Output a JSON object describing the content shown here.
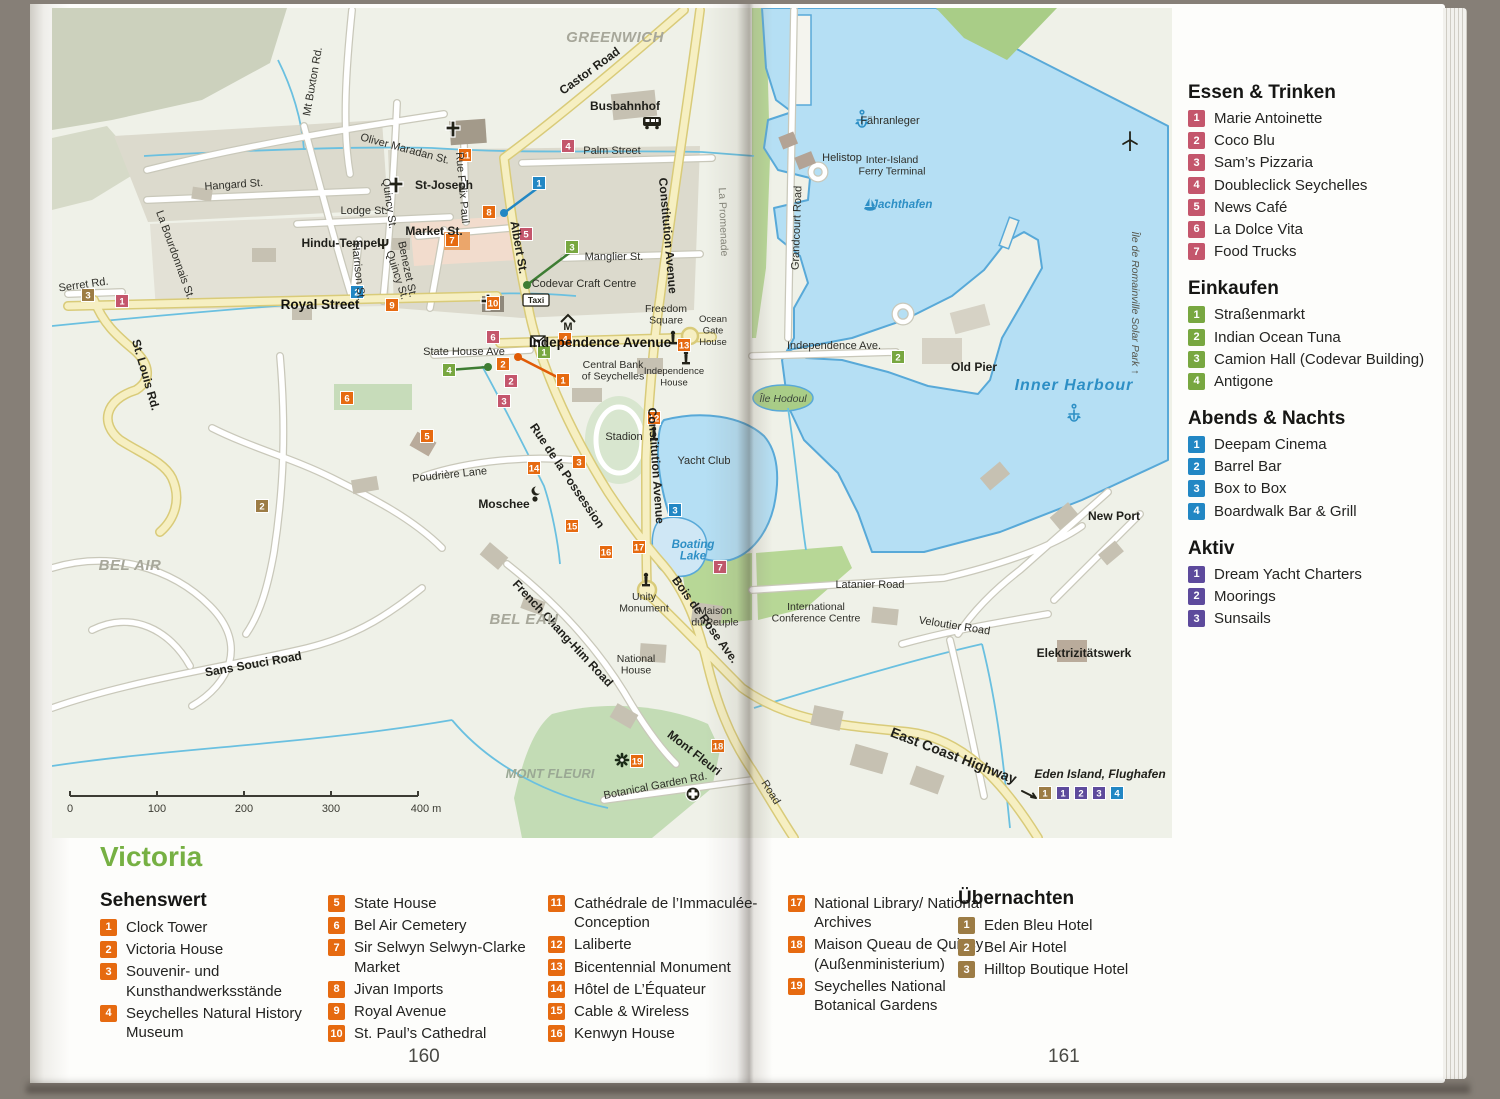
{
  "page": {
    "left_number": "160",
    "right_number": "161",
    "title": "Victoria"
  },
  "colors": {
    "essen": "#c4566c",
    "einkaufen": "#78a740",
    "abends": "#2287c4",
    "aktiv": "#5d4a9c",
    "sehenswert": "#e66a10",
    "uebernachten": "#9c7c45",
    "title_green": "#76b043",
    "water": "#b5dff4",
    "coast": "#58a9d8",
    "road_yellow": "#f6efc2",
    "land": "#eff1e8"
  },
  "sidebar_sections": [
    {
      "id": "essen",
      "title": "Essen & Trinken",
      "color": "#c4566c",
      "items": [
        "Marie Antoinette",
        "Coco Blu",
        "Sam’s Pizzaria",
        "Doubleclick Seychelles",
        "News Café",
        "La Dolce Vita",
        "Food Trucks"
      ]
    },
    {
      "id": "einkaufen",
      "title": "Einkaufen",
      "color": "#78a740",
      "items": [
        "Straßenmarkt",
        "Indian Ocean Tuna",
        "Camion Hall (Codevar Building)",
        "Antigone"
      ]
    },
    {
      "id": "abends",
      "title": "Abends & Nachts",
      "color": "#2287c4",
      "items": [
        "Deepam Cinema",
        "Barrel Bar",
        "Box to Box",
        "Boardwalk Bar & Grill"
      ]
    },
    {
      "id": "aktiv",
      "title": "Aktiv",
      "color": "#5d4a9c",
      "items": [
        "Dream Yacht Charters",
        "Moorings",
        "Sunsails"
      ]
    }
  ],
  "bottom_legend": {
    "sehenswert_title": "Sehenswert",
    "sehenswert_items": [
      "Clock Tower",
      "Victoria House",
      "Souvenir- und Kunsthandwerksstände",
      "Seychelles Natural History Museum",
      "State House",
      "Bel Air Cemetery",
      "Sir Selwyn Selwyn-Clarke Market",
      "Jivan Imports",
      "Royal Avenue",
      "St. Paul’s Cathedral",
      "Cathédrale de l’Immaculée-Conception",
      "Laliberte",
      "Bicentennial Monument",
      "Hôtel de L’Équateur",
      "Cable & Wireless",
      "Kenwyn House",
      "National Library/ National Archives",
      "Maison Queau de Quincy (Außenministerium)",
      "Seychelles National Botanical Gardens"
    ],
    "columns": [
      [
        1,
        4
      ],
      [
        5,
        10
      ],
      [
        11,
        16
      ],
      [
        17,
        19
      ]
    ],
    "uebernachten_title": "Übernachten",
    "uebernachten_items": [
      "Eden Bleu Hotel",
      "Bel Air Hotel",
      "Hilltop Boutique Hotel"
    ]
  },
  "map": {
    "scale": {
      "ticks": [
        "0",
        "100",
        "200",
        "300"
      ],
      "end": "400 m"
    },
    "labels": [
      {
        "t": "GREENWICH",
        "x": 563,
        "y": 34,
        "r": 0,
        "c": "area"
      },
      {
        "t": "Castor Road",
        "x": 540,
        "y": 66,
        "r": -36,
        "c": "stb"
      },
      {
        "t": "Busbahnhof",
        "x": 573,
        "y": 102,
        "r": 0,
        "c": "stb"
      },
      {
        "t": "Palm Street",
        "x": 560,
        "y": 146,
        "r": 0,
        "c": "st"
      },
      {
        "t": "St-Joseph",
        "x": 392,
        "y": 181,
        "r": 0,
        "c": "stb"
      },
      {
        "t": "Oliver Maradan St.",
        "x": 352,
        "y": 144,
        "r": 15,
        "c": "st"
      },
      {
        "t": "Mt Buxton Rd.",
        "x": 264,
        "y": 74,
        "r": -80,
        "c": "st"
      },
      {
        "t": "Hangard St.",
        "x": 182,
        "y": 180,
        "r": -4,
        "c": "st"
      },
      {
        "t": "La Bourdonnais St.",
        "x": 120,
        "y": 248,
        "r": 70,
        "c": "st"
      },
      {
        "t": "Lodge St.",
        "x": 312,
        "y": 206,
        "r": 0,
        "c": "st"
      },
      {
        "t": "Hindu-Tempel",
        "x": 289,
        "y": 239,
        "r": 0,
        "c": "stb"
      },
      {
        "t": "Quincy St.",
        "x": 334,
        "y": 196,
        "r": 82,
        "c": "st"
      },
      {
        "t": "Quincy St.",
        "x": 342,
        "y": 268,
        "r": 72,
        "c": "st"
      },
      {
        "t": "Harrison St.",
        "x": 303,
        "y": 264,
        "r": 84,
        "c": "st"
      },
      {
        "t": "Serret Rd.",
        "x": 32,
        "y": 280,
        "r": -8,
        "c": "st"
      },
      {
        "t": "Royal Street",
        "x": 268,
        "y": 301,
        "r": 0,
        "c": "big"
      },
      {
        "t": "St. Louis Rd.",
        "x": 90,
        "y": 368,
        "r": 74,
        "c": "stb"
      },
      {
        "t": "Rue Felix Paul",
        "x": 407,
        "y": 180,
        "r": 85,
        "c": "st"
      },
      {
        "t": "Benezet St.",
        "x": 352,
        "y": 262,
        "r": 78,
        "c": "st"
      },
      {
        "t": "Market St.",
        "x": 382,
        "y": 227,
        "r": 0,
        "c": "stb"
      },
      {
        "t": "Albert St.",
        "x": 463,
        "y": 240,
        "r": 80,
        "c": "stb"
      },
      {
        "t": "Codevar Craft Centre",
        "x": 532,
        "y": 279,
        "r": 0,
        "c": "st"
      },
      {
        "t": "Manglier St.",
        "x": 562,
        "y": 252,
        "r": 0,
        "c": "st"
      },
      {
        "t": "Constitution Avenue",
        "x": 612,
        "y": 228,
        "r": 85,
        "c": "stb"
      },
      {
        "t": "Constitution Avenue",
        "x": 600,
        "y": 458,
        "r": 86,
        "c": "stb"
      },
      {
        "t": "La Promenade",
        "x": 668,
        "y": 214,
        "r": 88,
        "c": "gray"
      },
      {
        "t": "Freedom\nSquare",
        "x": 614,
        "y": 304,
        "r": 0,
        "c": "st-c"
      },
      {
        "t": "Ocean\nGate\nHouse",
        "x": 661,
        "y": 314,
        "r": 0,
        "c": "tiny-c"
      },
      {
        "t": "Independence Avenue",
        "x": 548,
        "y": 339,
        "r": 0,
        "c": "big"
      },
      {
        "t": "Central Bank\nof Seychelles",
        "x": 561,
        "y": 360,
        "r": 0,
        "c": "st-c"
      },
      {
        "t": "Independence\nHouse",
        "x": 622,
        "y": 366,
        "r": 0,
        "c": "tiny-c"
      },
      {
        "t": "State House Ave",
        "x": 412,
        "y": 347,
        "r": 0,
        "c": "st"
      },
      {
        "t": "Stadion",
        "x": 572,
        "y": 432,
        "r": 0,
        "c": "st"
      },
      {
        "t": "Yacht Club",
        "x": 652,
        "y": 456,
        "r": 0,
        "c": "st"
      },
      {
        "t": "Boating\nLake",
        "x": 641,
        "y": 540,
        "r": 0,
        "c": "water-sm"
      },
      {
        "t": "Île Hodoul",
        "x": 731,
        "y": 394,
        "r": 0,
        "c": "island"
      },
      {
        "t": "Unity\nMonument",
        "x": 592,
        "y": 592,
        "r": 0,
        "c": "st-c"
      },
      {
        "t": "Bois de Rose Ave.",
        "x": 650,
        "y": 614,
        "r": 54,
        "c": "stb"
      },
      {
        "t": "Maison\ndu Peuple",
        "x": 663,
        "y": 606,
        "r": 0,
        "c": "st-c"
      },
      {
        "t": "National\nHouse",
        "x": 584,
        "y": 654,
        "r": 0,
        "c": "st-c"
      },
      {
        "t": "French Chang-Him Road",
        "x": 508,
        "y": 628,
        "r": 47,
        "c": "stb"
      },
      {
        "t": "Sans Souci Road",
        "x": 202,
        "y": 660,
        "r": -10,
        "c": "stb"
      },
      {
        "t": "Poudrière Lane",
        "x": 398,
        "y": 470,
        "r": -6,
        "c": "st"
      },
      {
        "t": "Moschee",
        "x": 452,
        "y": 500,
        "r": 0,
        "c": "stb"
      },
      {
        "t": "Rue de la Possession",
        "x": 512,
        "y": 470,
        "r": 56,
        "c": "stb"
      },
      {
        "t": "Mont Fleuri",
        "x": 640,
        "y": 748,
        "r": 38,
        "c": "stb"
      },
      {
        "t": "Botanical Garden Rd.",
        "x": 604,
        "y": 781,
        "r": -11,
        "c": "st"
      },
      {
        "t": "BEL AIR",
        "x": 78,
        "y": 562,
        "r": 0,
        "c": "area"
      },
      {
        "t": "BEL EAU",
        "x": 472,
        "y": 616,
        "r": 0,
        "c": "area"
      },
      {
        "t": "MONT FLEURI",
        "x": 498,
        "y": 770,
        "r": 0,
        "c": "area2"
      },
      {
        "t": "Fähranleger",
        "x": 838,
        "y": 116,
        "r": 0,
        "c": "st"
      },
      {
        "t": "Helistop",
        "x": 790,
        "y": 153,
        "r": 0,
        "c": "st"
      },
      {
        "t": "Inter-Island\nFerry Terminal",
        "x": 840,
        "y": 155,
        "r": 0,
        "c": "st-c"
      },
      {
        "t": "Jachthafen",
        "x": 850,
        "y": 200,
        "r": 0,
        "c": "water-sm"
      },
      {
        "t": "Grandcourt Road",
        "x": 748,
        "y": 220,
        "r": -88,
        "c": "st"
      },
      {
        "t": "Independence Ave.",
        "x": 782,
        "y": 341,
        "r": 0,
        "c": "st"
      },
      {
        "t": "Old Pier",
        "x": 922,
        "y": 363,
        "r": 0,
        "c": "stb"
      },
      {
        "t": "Inner Harbour",
        "x": 1022,
        "y": 382,
        "r": 0,
        "c": "water"
      },
      {
        "t": "Île de Romainville Solar Park ↑",
        "x": 1080,
        "y": 295,
        "r": 90,
        "c": "solar"
      },
      {
        "t": "New Port",
        "x": 1062,
        "y": 512,
        "r": 0,
        "c": "stb"
      },
      {
        "t": "Latanier Road",
        "x": 818,
        "y": 580,
        "r": 0,
        "c": "st"
      },
      {
        "t": "International\nConference Centre",
        "x": 764,
        "y": 602,
        "r": 0,
        "c": "st-c"
      },
      {
        "t": "Veloutier Road",
        "x": 902,
        "y": 621,
        "r": 9,
        "c": "st"
      },
      {
        "t": "Elektrizitätswerk",
        "x": 1032,
        "y": 649,
        "r": 0,
        "c": "stb"
      },
      {
        "t": "East Coast Highway",
        "x": 900,
        "y": 752,
        "r": 21,
        "c": "hwy"
      },
      {
        "t": "Eden Island, Flughafen",
        "x": 1048,
        "y": 770,
        "r": 0,
        "c": "edn"
      },
      {
        "t": "Road",
        "x": 716,
        "y": 786,
        "r": 58,
        "c": "st"
      }
    ],
    "markers": [
      {
        "g": "sehenswert",
        "n": "1",
        "x": 511,
        "y": 372
      },
      {
        "g": "sehenswert",
        "n": "2",
        "x": 451,
        "y": 356
      },
      {
        "g": "sehenswert",
        "n": "3",
        "x": 527,
        "y": 454
      },
      {
        "g": "sehenswert",
        "n": "4",
        "x": 513,
        "y": 331
      },
      {
        "g": "sehenswert",
        "n": "5",
        "x": 375,
        "y": 428
      },
      {
        "g": "sehenswert",
        "n": "6",
        "x": 295,
        "y": 390
      },
      {
        "g": "sehenswert",
        "n": "7",
        "x": 400,
        "y": 232
      },
      {
        "g": "sehenswert",
        "n": "8",
        "x": 437,
        "y": 204
      },
      {
        "g": "sehenswert",
        "n": "9",
        "x": 340,
        "y": 297
      },
      {
        "g": "sehenswert",
        "n": "10",
        "x": 441,
        "y": 295
      },
      {
        "g": "sehenswert",
        "n": "11",
        "x": 413,
        "y": 147
      },
      {
        "g": "sehenswert",
        "n": "12",
        "x": 602,
        "y": 410
      },
      {
        "g": "sehenswert",
        "n": "13",
        "x": 632,
        "y": 337
      },
      {
        "g": "sehenswert",
        "n": "14",
        "x": 482,
        "y": 460
      },
      {
        "g": "sehenswert",
        "n": "15",
        "x": 520,
        "y": 518
      },
      {
        "g": "sehenswert",
        "n": "16",
        "x": 554,
        "y": 544
      },
      {
        "g": "sehenswert",
        "n": "17",
        "x": 587,
        "y": 539
      },
      {
        "g": "sehenswert",
        "n": "18",
        "x": 666,
        "y": 738
      },
      {
        "g": "sehenswert",
        "n": "19",
        "x": 585,
        "y": 753
      },
      {
        "g": "essen",
        "n": "1",
        "x": 70,
        "y": 293
      },
      {
        "g": "essen",
        "n": "2",
        "x": 459,
        "y": 373
      },
      {
        "g": "essen",
        "n": "3",
        "x": 452,
        "y": 393
      },
      {
        "g": "essen",
        "n": "4",
        "x": 516,
        "y": 138
      },
      {
        "g": "essen",
        "n": "5",
        "x": 474,
        "y": 226
      },
      {
        "g": "essen",
        "n": "6",
        "x": 441,
        "y": 329
      },
      {
        "g": "essen",
        "n": "7",
        "x": 668,
        "y": 559
      },
      {
        "g": "einkaufen",
        "n": "1",
        "x": 492,
        "y": 344
      },
      {
        "g": "einkaufen",
        "n": "2",
        "x": 846,
        "y": 349
      },
      {
        "g": "einkaufen",
        "n": "3",
        "x": 520,
        "y": 239
      },
      {
        "g": "einkaufen",
        "n": "4",
        "x": 397,
        "y": 362
      },
      {
        "g": "abends",
        "n": "1",
        "x": 487,
        "y": 175
      },
      {
        "g": "abends",
        "n": "2",
        "x": 305,
        "y": 284
      },
      {
        "g": "abends",
        "n": "3",
        "x": 623,
        "y": 502
      },
      {
        "g": "abends",
        "n": "4",
        "x": 1065,
        "y": 785
      },
      {
        "g": "aktiv",
        "n": "1",
        "x": 1011,
        "y": 785
      },
      {
        "g": "aktiv",
        "n": "2",
        "x": 1029,
        "y": 785
      },
      {
        "g": "aktiv",
        "n": "3",
        "x": 1047,
        "y": 785
      },
      {
        "g": "uebernachten",
        "n": "1",
        "x": 993,
        "y": 785
      },
      {
        "g": "uebernachten",
        "n": "2",
        "x": 210,
        "y": 498
      },
      {
        "g": "uebernachten",
        "n": "3",
        "x": 36,
        "y": 287
      }
    ],
    "leaders": [
      {
        "x1": 511,
        "y1": 372,
        "x2": 466,
        "y2": 349,
        "col": "#e05b07"
      },
      {
        "x1": 397,
        "y1": 362,
        "x2": 436,
        "y2": 359,
        "col": "#3e7d33"
      },
      {
        "x1": 520,
        "y1": 243,
        "x2": 475,
        "y2": 277,
        "col": "#3e7d33"
      },
      {
        "x1": 487,
        "y1": 179,
        "x2": 452,
        "y2": 205,
        "col": "#2287c4"
      }
    ],
    "icons": [
      {
        "k": "church",
        "x": 401,
        "y": 121
      },
      {
        "k": "church",
        "x": 344,
        "y": 177
      },
      {
        "k": "cross",
        "x": 436,
        "y": 294
      },
      {
        "k": "trident",
        "x": 331,
        "y": 236
      },
      {
        "k": "bus",
        "x": 600,
        "y": 114
      },
      {
        "k": "mail",
        "x": 486,
        "y": 333
      },
      {
        "k": "museum",
        "x": 516,
        "y": 314
      },
      {
        "k": "taxi",
        "x": 484,
        "y": 292
      },
      {
        "k": "monument",
        "x": 594,
        "y": 572
      },
      {
        "k": "monument",
        "x": 602,
        "y": 426
      },
      {
        "k": "monument",
        "x": 634,
        "y": 350
      },
      {
        "k": "monument",
        "x": 621,
        "y": 330
      },
      {
        "k": "crescent",
        "x": 484,
        "y": 487
      },
      {
        "k": "flower",
        "x": 570,
        "y": 752
      },
      {
        "k": "medcross",
        "x": 641,
        "y": 786
      },
      {
        "k": "anchor",
        "x": 810,
        "y": 112
      },
      {
        "k": "sail",
        "x": 818,
        "y": 198
      },
      {
        "k": "anchor",
        "x": 1022,
        "y": 406
      },
      {
        "k": "turbine",
        "x": 1078,
        "y": 132
      },
      {
        "k": "arrow",
        "x": 978,
        "y": 787
      }
    ]
  }
}
